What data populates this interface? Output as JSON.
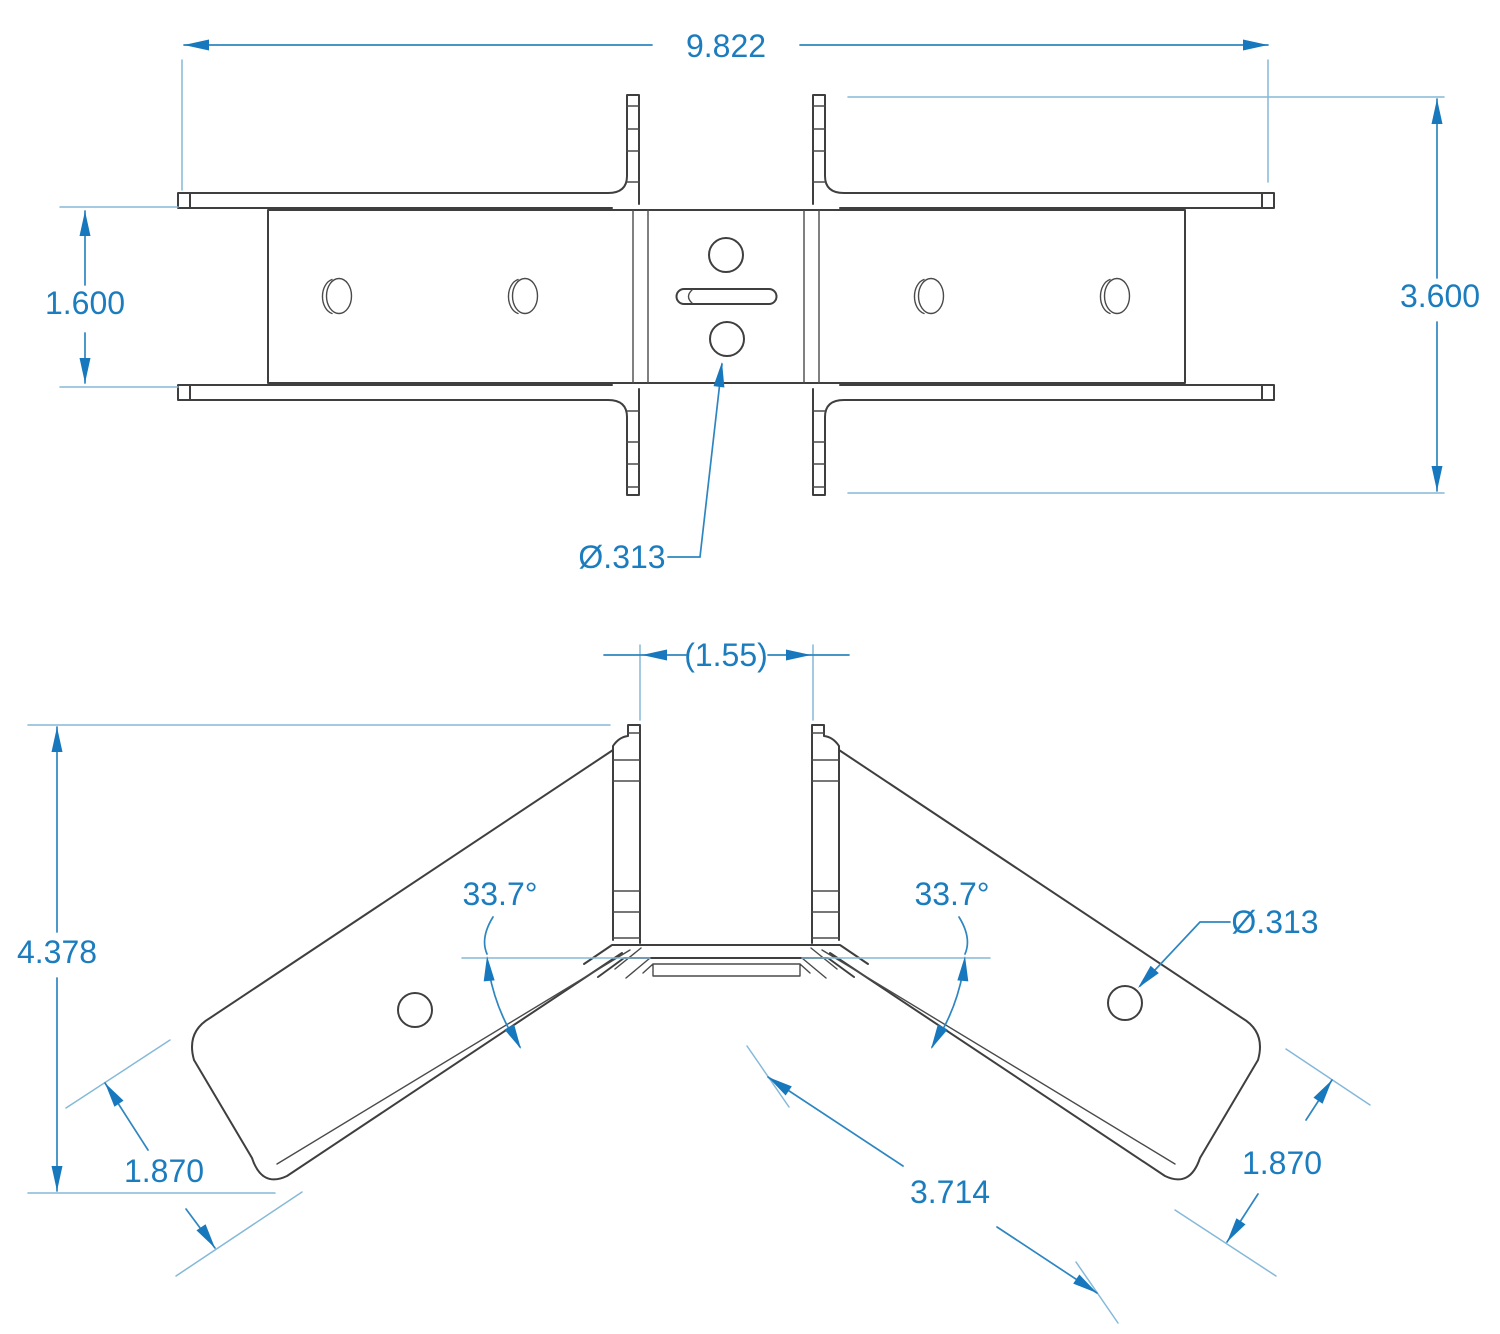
{
  "drawing": {
    "type": "engineering-drawing",
    "part": "sheet-metal bracket, two orthographic views",
    "colors": {
      "dimension_text_blue": "#1b7cbe",
      "dimension_line_blue": "#2e86c1",
      "extension_line_blue": "#85b9d9",
      "part_line": "#3f3f3f",
      "background": "#ffffff"
    },
    "top_view": {
      "overall_length": "9.822",
      "band_width": "1.600",
      "overall_height": "3.600",
      "hole_diameter": "Ø.313"
    },
    "bottom_view": {
      "channel_width_ref": "(1.55)",
      "overall_height": "4.378",
      "bend_angle_left": "33.7°",
      "bend_angle_right": "33.7°",
      "hole_diameter": "Ø.313",
      "flange_width_left": "1.870",
      "flange_length": "3.714",
      "flange_width_right": "1.870"
    }
  }
}
